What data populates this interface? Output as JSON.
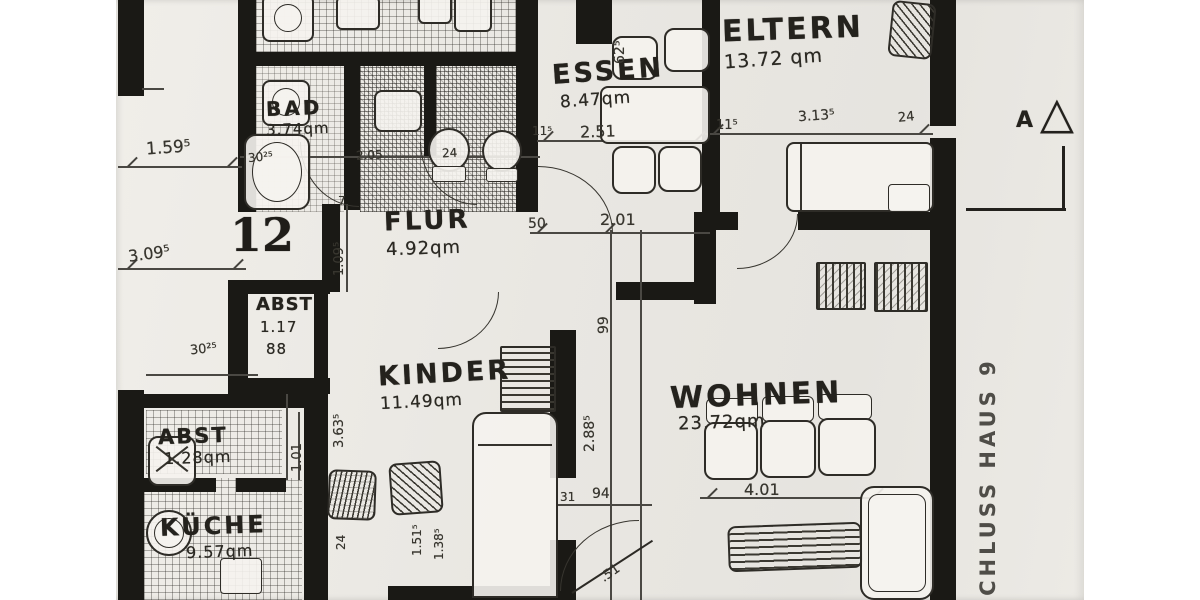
{
  "plan": {
    "rooms": {
      "bad": {
        "name": "BAD",
        "area": "3.74qm"
      },
      "essen": {
        "name": "ESSEN",
        "area": "8.47qm"
      },
      "eltern": {
        "name": "ELTERN",
        "area": "13.72 qm"
      },
      "flur": {
        "name": "FLUR",
        "area": "4.92qm"
      },
      "abst_upper": {
        "name": "ABST",
        "dim1": "1.17",
        "dim2": "88"
      },
      "kinder": {
        "name": "KINDER",
        "area": "11.49qm"
      },
      "wohnen": {
        "name": "WOHNEN",
        "area": "23.72qm"
      },
      "abst_lower": {
        "name": "ABST",
        "area": "1.28qm"
      },
      "kueche": {
        "name": "KÜCHE",
        "area": "9.57qm"
      }
    },
    "dims": [
      "1.59⁵",
      "3.09⁵",
      "62⁵",
      "30²⁵",
      "2.05",
      "24",
      "11⁵",
      "2.51",
      "11⁵",
      "3.13⁵",
      "24",
      "50",
      "2.01",
      "7",
      "1.09⁵",
      "99",
      "2.88⁵",
      "30²⁵",
      "3.63⁵",
      "1.01",
      "4.01",
      "24",
      "1.51⁵",
      "1.38⁵",
      "31",
      "94",
      ".51"
    ],
    "annotations": {
      "unit_number": "12",
      "section_letter": "A",
      "section_symbol": "△",
      "side_text": "SCHLUSS HAUS 9"
    }
  }
}
